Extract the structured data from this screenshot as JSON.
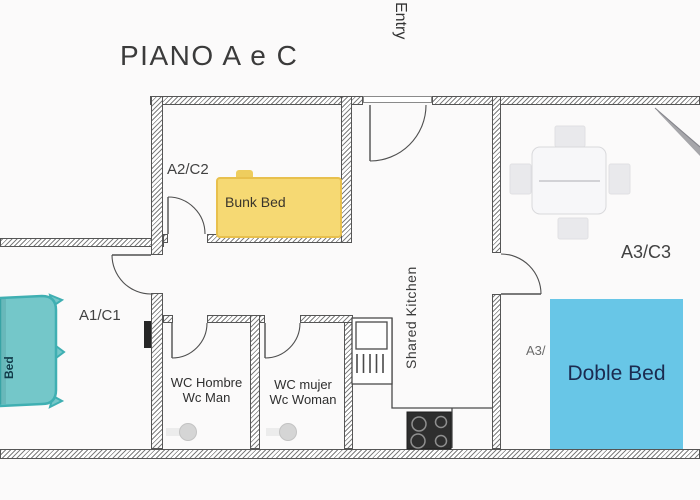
{
  "title": "PIANO A e C",
  "labels": {
    "entry": "Entry",
    "room_a2c2": "A2/C2",
    "room_a1c1": "A1/C1",
    "room_a3c3": "A3/C3",
    "room_a3_partial": "A3/",
    "shared_kitchen": "Shared Kitchen",
    "wc_men": {
      "line1": "WC Hombre",
      "line2": "Wc Man"
    },
    "wc_women": {
      "line1": "WC mujer",
      "line2": "Wc Woman"
    }
  },
  "furniture": {
    "bunk_bed_label": "Bunk Bed",
    "double_bed_label": "Doble Bed",
    "single_bed_label": "Bed"
  },
  "colors": {
    "bunk_bed_fill": "#f6d973",
    "bunk_bed_border": "#e8c04d",
    "double_bed_fill": "#68c6e7",
    "double_bed_text": "#1b2b50",
    "single_bed_fill": "#74c7c9",
    "single_bed_border": "#3fafb2",
    "wall_line": "#4f4f4f"
  }
}
